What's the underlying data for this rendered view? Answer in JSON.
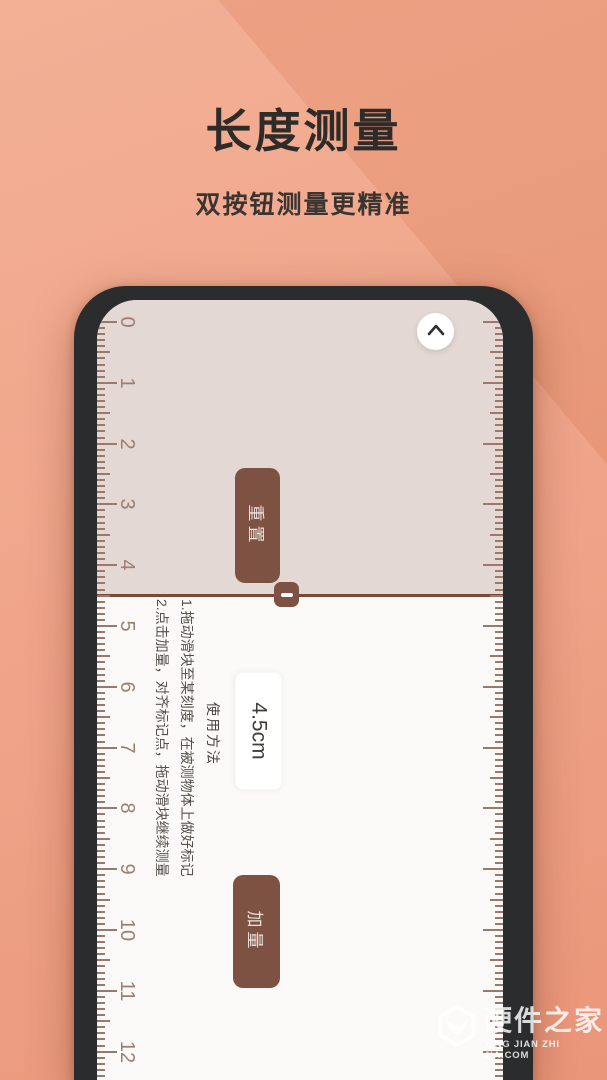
{
  "hero": {
    "title": "长度测量",
    "subtitle": "双按钮测量更精准"
  },
  "phone": {
    "chevron_icon": "chevron-up",
    "reset_button": "重置",
    "measurement": "4.5cm",
    "add_button": "加量",
    "instructions": {
      "heading": "使用方法",
      "step1": "1.拖动滑块至某刻度，在被测物体上做好标记",
      "step2": "2.点击加量，对齐标记点，拖动滑块继续测量"
    },
    "ruler": {
      "unit_numbers": [
        0,
        1,
        2,
        3,
        4,
        5,
        6,
        7,
        8,
        9,
        10,
        11,
        12
      ],
      "cm_px": 60.8,
      "origin_px": 22,
      "subdivisions": 10,
      "first_tick_index": -3,
      "last_tick_index": 125
    }
  },
  "watermark": {
    "name": "硬件之家",
    "domain": "YING JIAN ZHI JIA.COM"
  },
  "colors": {
    "bg_top": "#f3aa8d",
    "bg_bottom": "#e98f71",
    "frame": "#2b2c2e",
    "screen_top": "#e3d8d3",
    "screen_bottom": "#fbfaf9",
    "accent_brown": "#7e5242",
    "divider": "#7c4939",
    "tick": "#9a786c",
    "number": "#9c7e73",
    "title_text": "#2e2b29",
    "button_text": "#ece2dc",
    "watermark": "#ffffff"
  }
}
